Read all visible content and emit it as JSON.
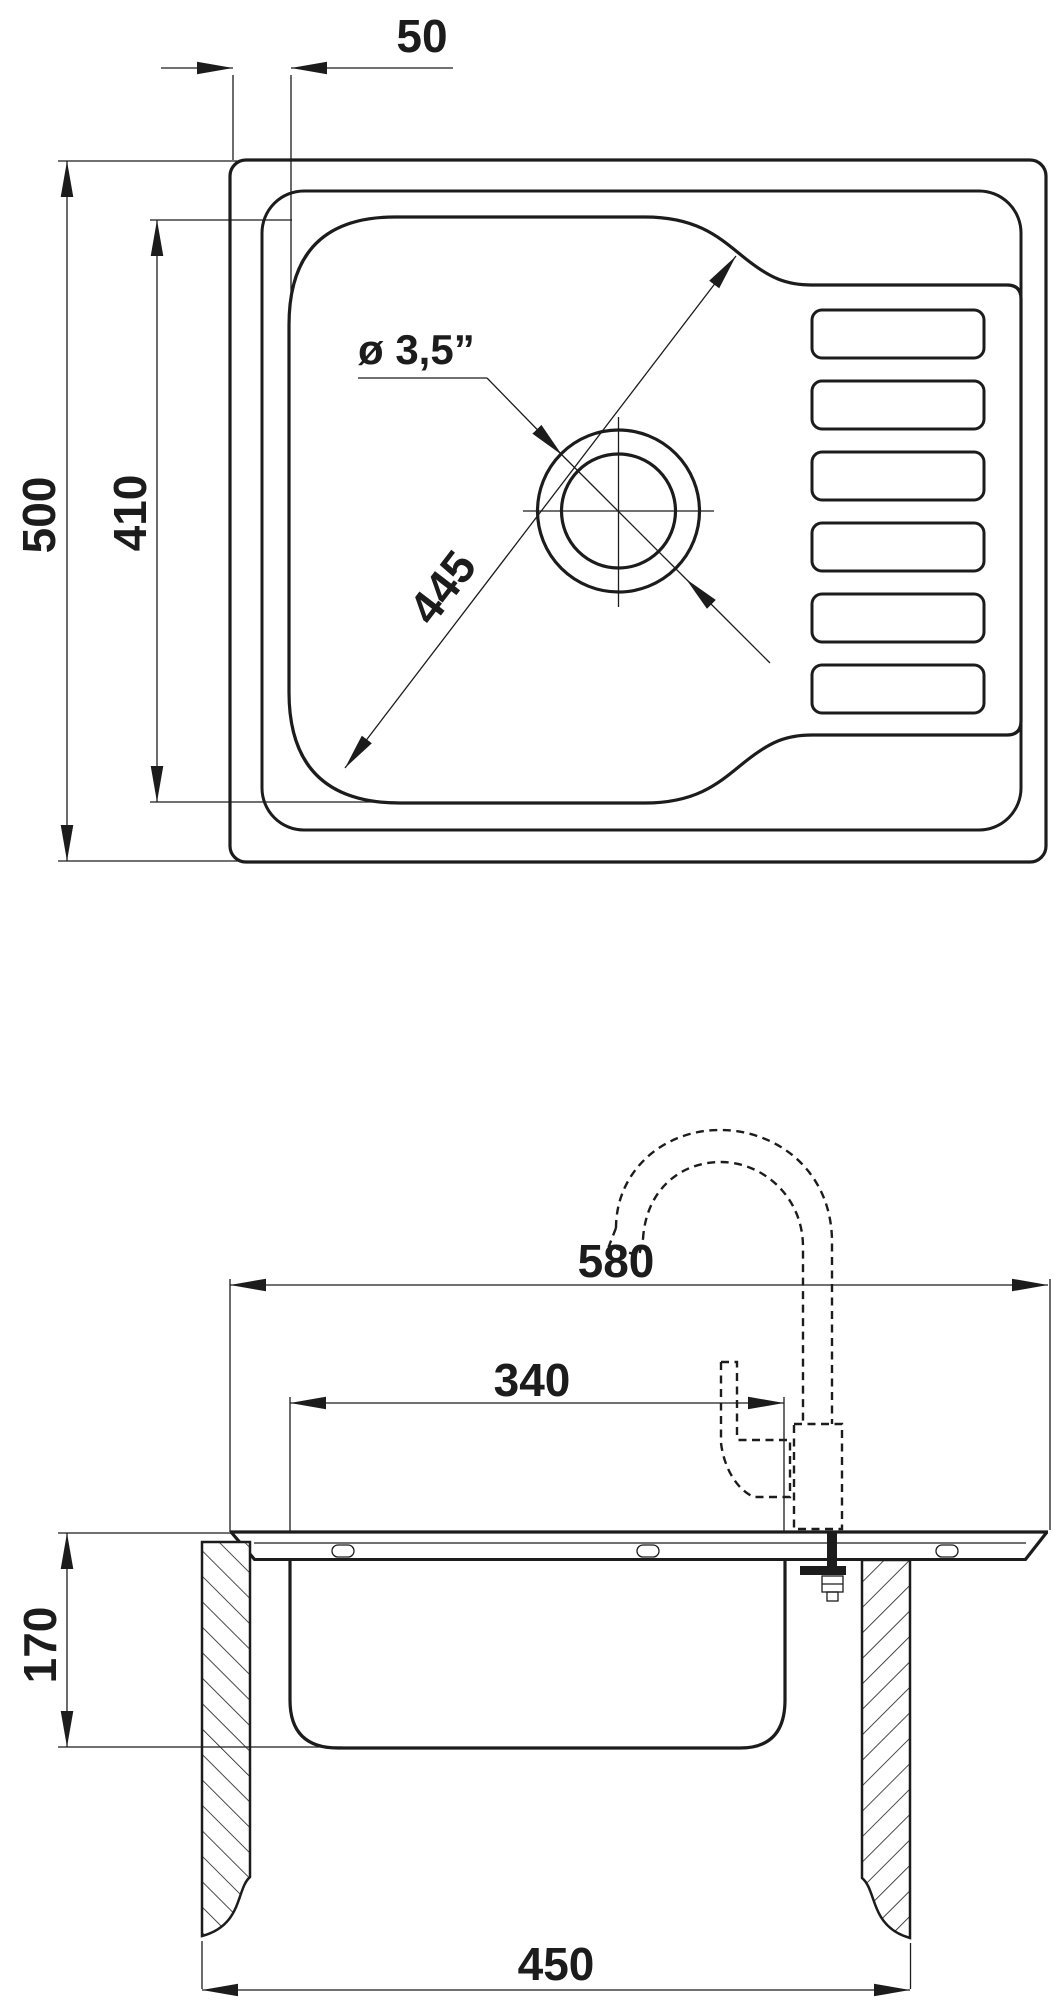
{
  "drawing": {
    "kind": "kitchen sink technical dimension drawing",
    "line_color": "#1c1c1c",
    "background": "#ffffff"
  },
  "views": {
    "top": {
      "name": "top view",
      "dimensions": {
        "rim_offset": {
          "label": "50"
        },
        "overall_depth": {
          "label": "500"
        },
        "bowl_depth": {
          "label": "410"
        },
        "bowl_diagonal": {
          "label": "445"
        },
        "drain_diameter": {
          "label": "ø 3,5”"
        }
      }
    },
    "side": {
      "name": "front section view",
      "dimensions": {
        "overall_width": {
          "label": "580"
        },
        "bowl_width": {
          "label": "340"
        },
        "bowl_height": {
          "label": "170"
        },
        "cabinet_width": {
          "label": "450"
        }
      }
    }
  }
}
